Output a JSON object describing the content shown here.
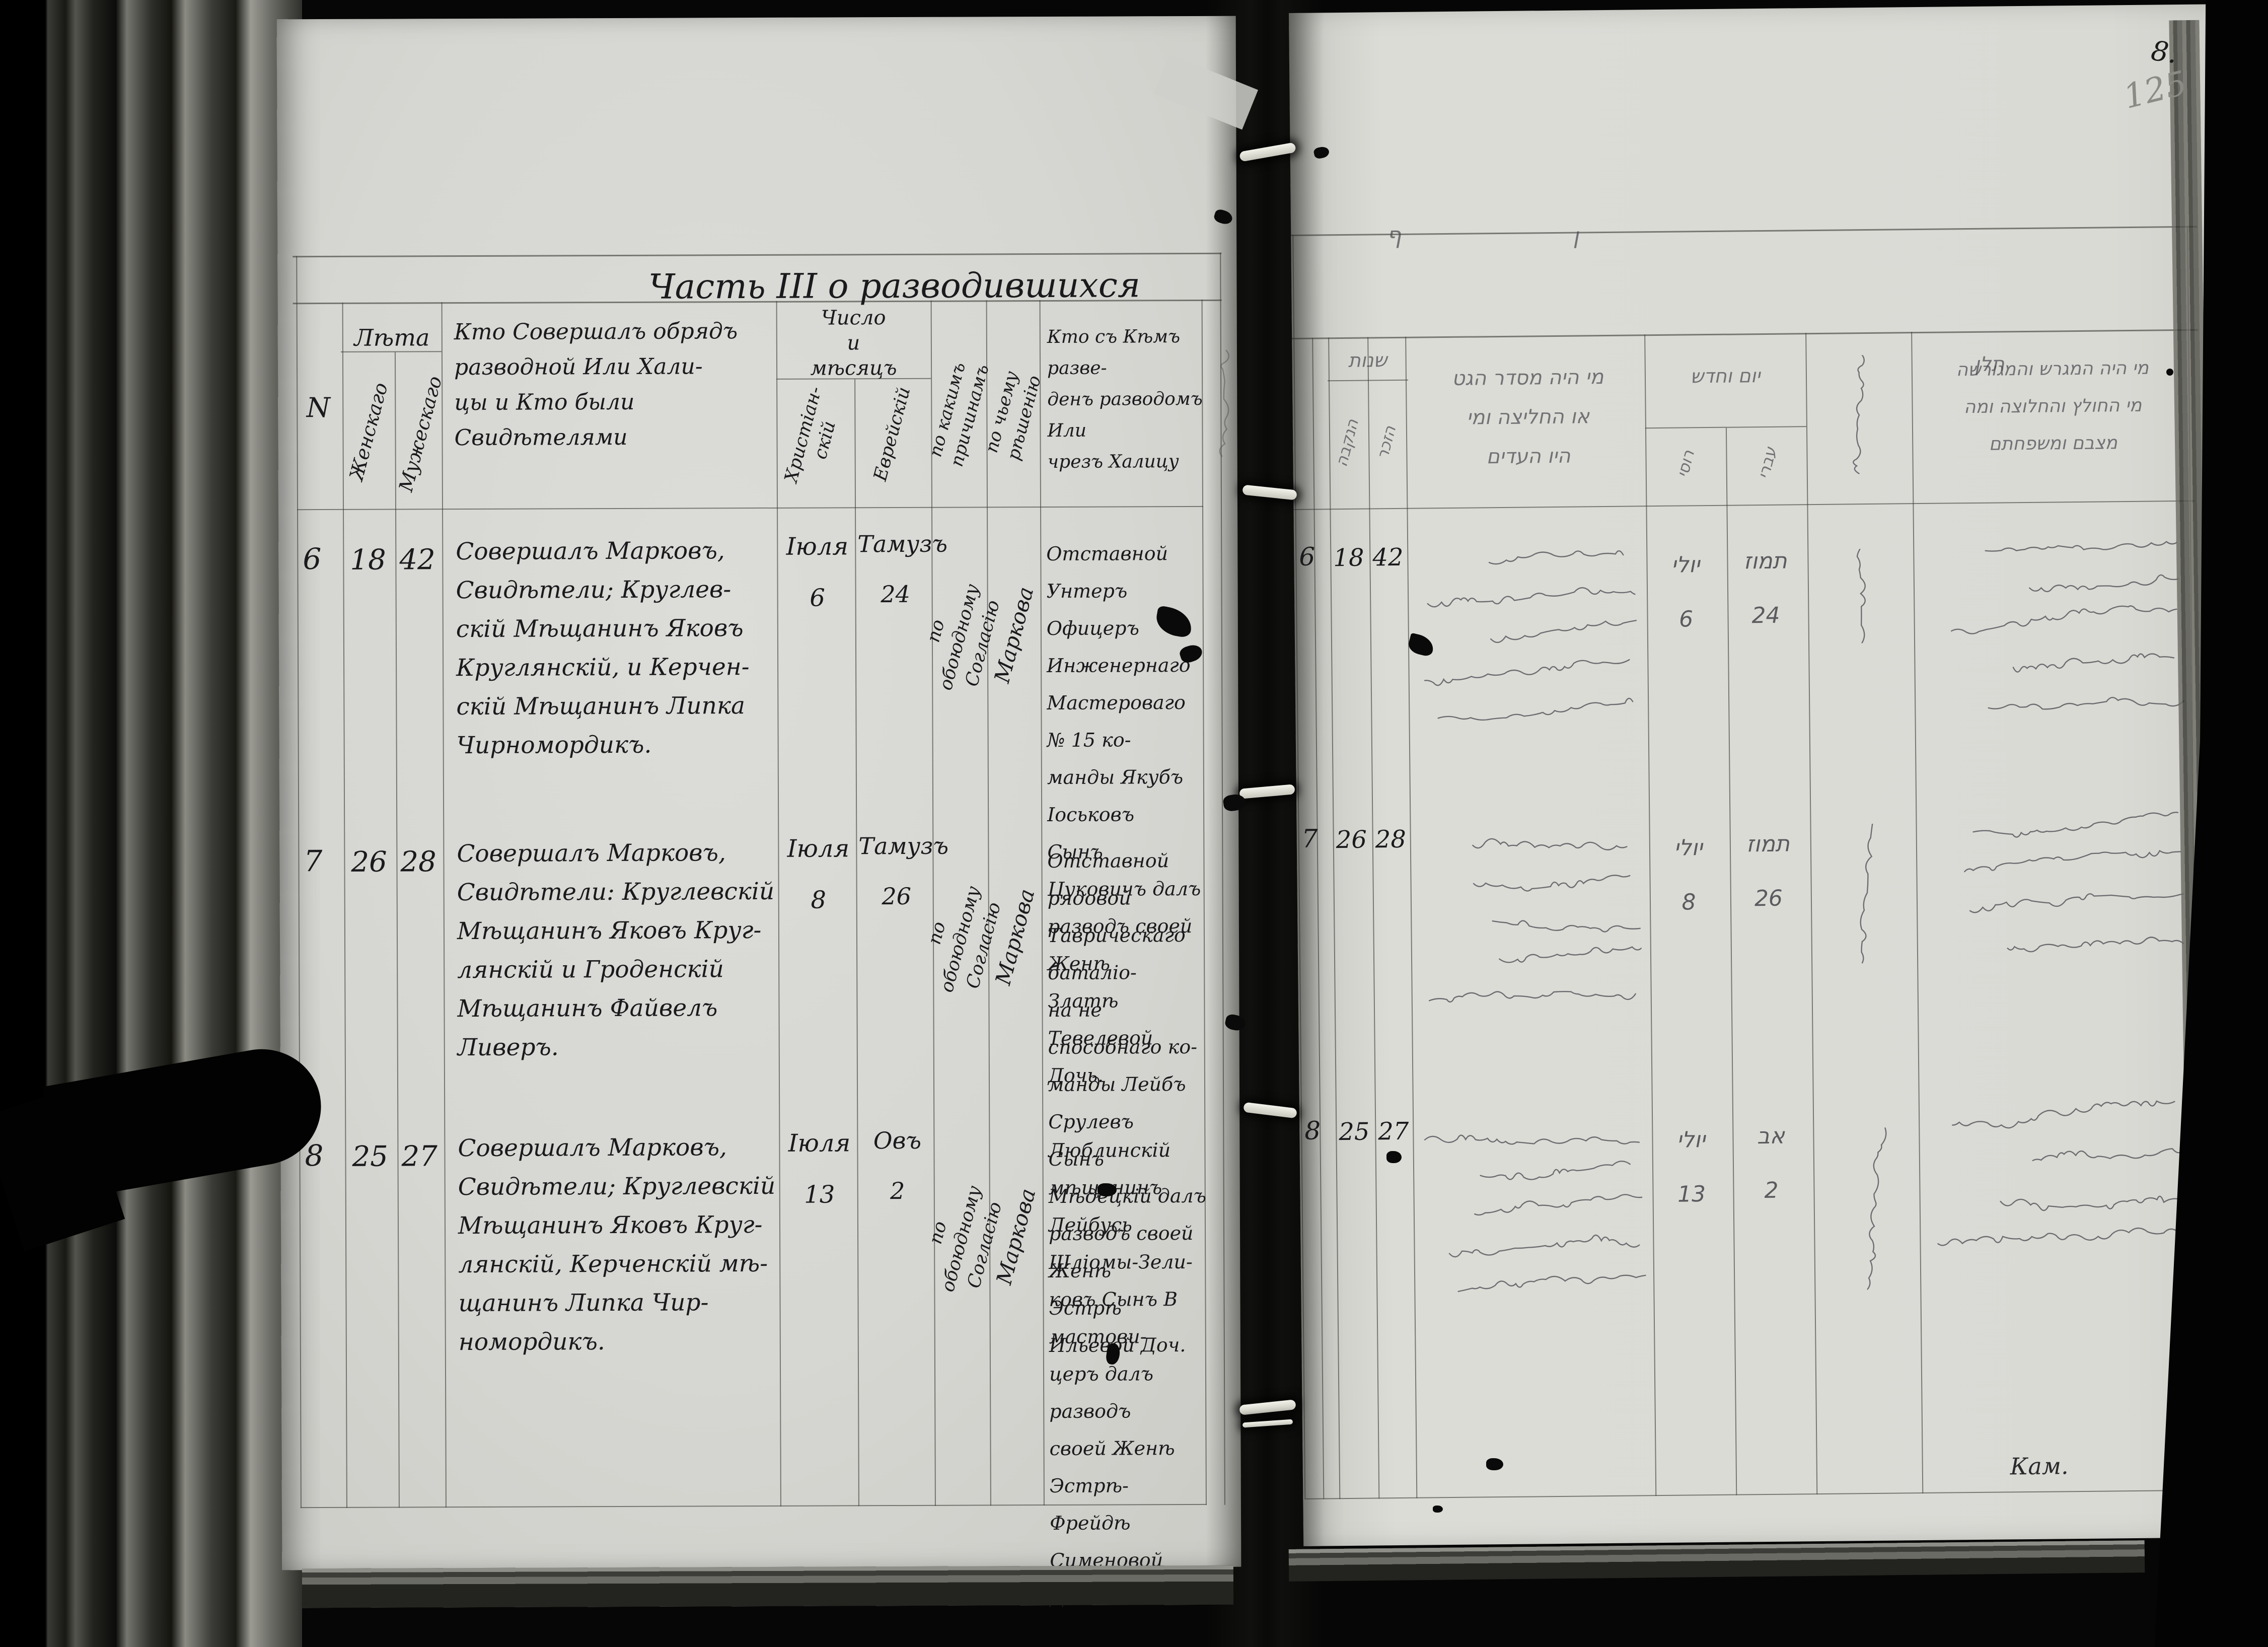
{
  "corner": {
    "ink": "8.",
    "pencil": "125"
  },
  "left_page": {
    "title": "Часть III о разводившихся",
    "header": {
      "no": "N",
      "ages": {
        "label": "Лѣта",
        "female": "Женскаго",
        "male": "Мужескаго"
      },
      "performer": "Кто Совершалъ обрядъ\nразводной Или Хали-\nцы и Кто были\nСвидѣтелями",
      "date": {
        "label": "Число\nи\nмѣсяцъ",
        "christian": "Христіан-\nскій",
        "jewish": "Еврейскій"
      },
      "reason": "по какимъ\nпричинамъ",
      "decision": "по чьему\nрѣшенію",
      "divorced": "Кто съ Кѣмъ разве-\nденъ разводомъ Или\nчрезъ Халицу"
    },
    "rows": [
      {
        "no": "6",
        "age_f": "18",
        "age_m": "42",
        "performer": "Совершалъ Марковъ,\nСвидѣтели; Круглев-\nскій Мѣщанинъ Яковъ\nКруглянскій, и Керчен-\nскій Мѣщанинъ Липка\nЧирномордикъ.",
        "date_christian": "Іюля\n6",
        "date_jewish": "Тамузъ\n24",
        "reason": "по обоюдному\nСогласію",
        "decision": "Маркова",
        "divorced": "Отставной Унтеръ\nОфицеръ Инженернаго\nМастероваго № 15 ко-\nманды Якубъ Іоськовъ\nСынъ Цуковичъ далъ\nразводъ своей Женѣ\nЗлатѣ Тевелевой\nДочь."
      },
      {
        "no": "7",
        "age_f": "26",
        "age_m": "28",
        "performer": "Совершалъ Марковъ,\nСвидѣтели: Круглевскій\nМѣщанинъ Яковъ Круг-\nлянскій и Гроденскій\nМѣщанинъ Файвелъ\nЛиверъ.",
        "date_christian": "Іюля\n8",
        "date_jewish": "Тамузъ\n26",
        "reason": "по обоюдному\nСогласію",
        "decision": "Маркова",
        "divorced": "Отставной рядовой\nТаврическаго баталіо-\nна не способнаго ко-\nманды Лейбъ Срулевъ\nСынъ Мѣдецкій далъ\nразводъ своей Женѣ\nЭстрѣ Ильевой Доч."
      },
      {
        "no": "8",
        "age_f": "25",
        "age_m": "27",
        "performer": "Совершалъ Марковъ,\nСвидѣтели; Круглевскій\nМѣщанинъ Яковъ Круг-\nлянскій, Керченскій мѣ-\nщанинъ Липка Чир-\nномордикъ.",
        "date_christian": "Іюля\n13",
        "date_jewish": "Овъ\n2",
        "reason": "по обоюдному\nСогласію",
        "decision": "Маркова",
        "divorced": "Люблинскій мѣщанинъ\nЛейбусь Шліомы-Зели-\nковъ Сынъ В мастови-\nцеръ далъ разводъ\nсвоей Женѣ Эстрѣ-\nФрейдѣ Сименовой Доч."
      }
    ]
  },
  "right_page": {
    "header": {
      "ages_label": "שנות",
      "age_f": "הנקבה",
      "age_m": "הזכר",
      "performer": "מי היה מסדר הגט\nאו החליצה ומי\nהיו העדים",
      "date_label": "יום וחדש",
      "date_russian": "רוסי",
      "date_jewish": "עברי",
      "divorced": "מי היה המגרש והמגורשה\nמי החולץ והחלוצה ומה\nמצבם ומשפחתם"
    },
    "scribbles": [
      "ף",
      "ן",
      "תלן"
    ],
    "legibility_note": "row entries written in faint Yiddish/Hebrew cursive, largely illegible",
    "rows": [
      {
        "no": "6",
        "age_f": "18",
        "age_m": "42",
        "date_russian": "יולי\n6",
        "date_jewish": "תמוז\n24",
        "script_lines": 5,
        "side_lines": 5
      },
      {
        "no": "7",
        "age_f": "26",
        "age_m": "28",
        "date_russian": "יולי\n8",
        "date_jewish": "תמוז\n26",
        "script_lines": 5,
        "side_lines": 4
      },
      {
        "no": "8",
        "age_f": "25",
        "age_m": "27",
        "date_russian": "יולי\n13",
        "date_jewish": "אב\n2",
        "script_lines": 5,
        "side_lines": 4,
        "signature": "Кам."
      }
    ]
  }
}
